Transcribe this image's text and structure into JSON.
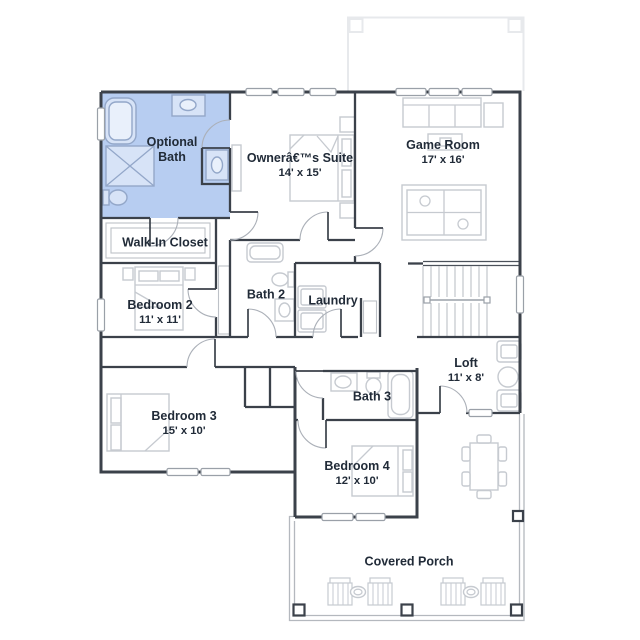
{
  "colors": {
    "wall": "#3b414a",
    "furniture": "#c6cad0",
    "highlight": "#b7cdf1",
    "bathfix": "#93a7c9",
    "label": "#212b38",
    "faint": "#e7e9ec",
    "porch": "#b4b8be"
  },
  "rooms": [
    {
      "id": "optional-bath",
      "label": "Optional Bath",
      "dims": ""
    },
    {
      "id": "walk-in-closet",
      "label": "Walk-In Closet",
      "dims": ""
    },
    {
      "id": "owners-suite",
      "label": "Ownerâ€™s Suite",
      "dims": "14' x 15'"
    },
    {
      "id": "game-room",
      "label": "Game Room",
      "dims": "17' x 16'"
    },
    {
      "id": "bedroom-2",
      "label": "Bedroom 2",
      "dims": "11' x 11'"
    },
    {
      "id": "bath-2",
      "label": "Bath 2",
      "dims": ""
    },
    {
      "id": "laundry",
      "label": "Laundry",
      "dims": ""
    },
    {
      "id": "bedroom-3",
      "label": "Bedroom 3",
      "dims": "15' x 10'"
    },
    {
      "id": "bath-3",
      "label": "Bath 3",
      "dims": ""
    },
    {
      "id": "bedroom-4",
      "label": "Bedroom 4",
      "dims": "12' x 10'"
    },
    {
      "id": "loft",
      "label": "Loft",
      "dims": "11' x 8'"
    },
    {
      "id": "covered-porch",
      "label": "Covered Porch",
      "dims": ""
    }
  ]
}
